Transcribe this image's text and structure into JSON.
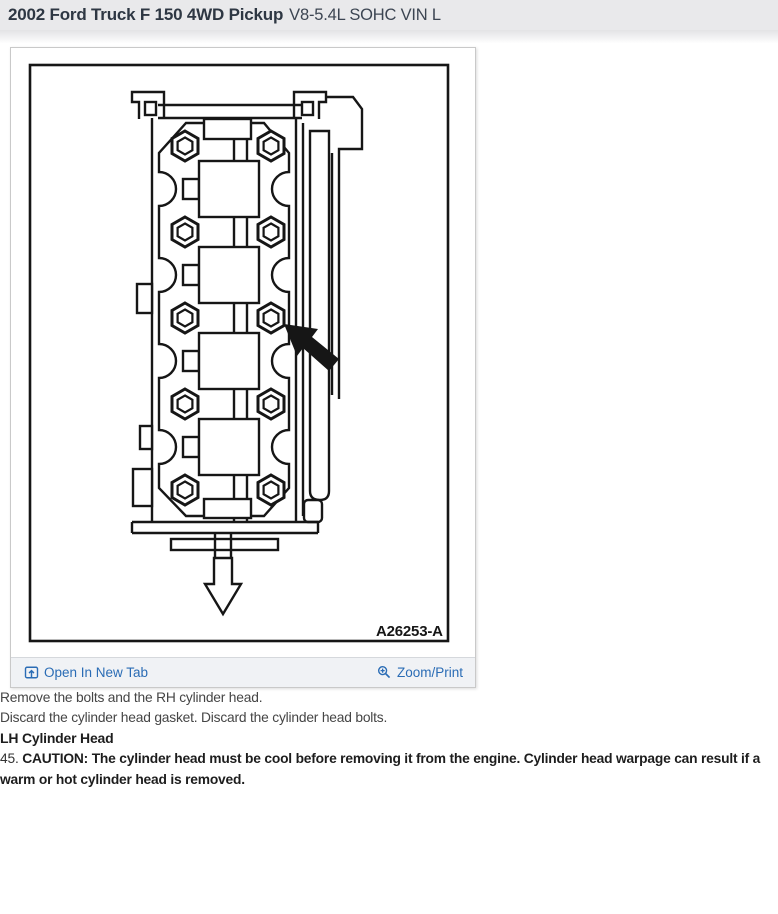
{
  "header": {
    "vehicle": "2002 Ford Truck F 150 4WD Pickup",
    "engine": "V8-5.4L SOHC VIN L"
  },
  "figure": {
    "code": "A26253-A",
    "open_in_new_tab": "Open In New Tab",
    "zoom_print": "Zoom/Print"
  },
  "steps": {
    "remove": "Remove the bolts and the RH cylinder head.",
    "discard": "Discard the cylinder head gasket. Discard the cylinder head bolts.",
    "section_heading": "LH Cylinder Head",
    "step_number": "45.",
    "caution": "CAUTION: The cylinder head must be cool before removing it from the engine. Cylinder head warpage can result if a warm or hot cylinder head is removed."
  },
  "colors": {
    "link": "#2a6cb5",
    "header_bg": "#e9e9eb",
    "footer_bg": "#f0f2f5"
  }
}
